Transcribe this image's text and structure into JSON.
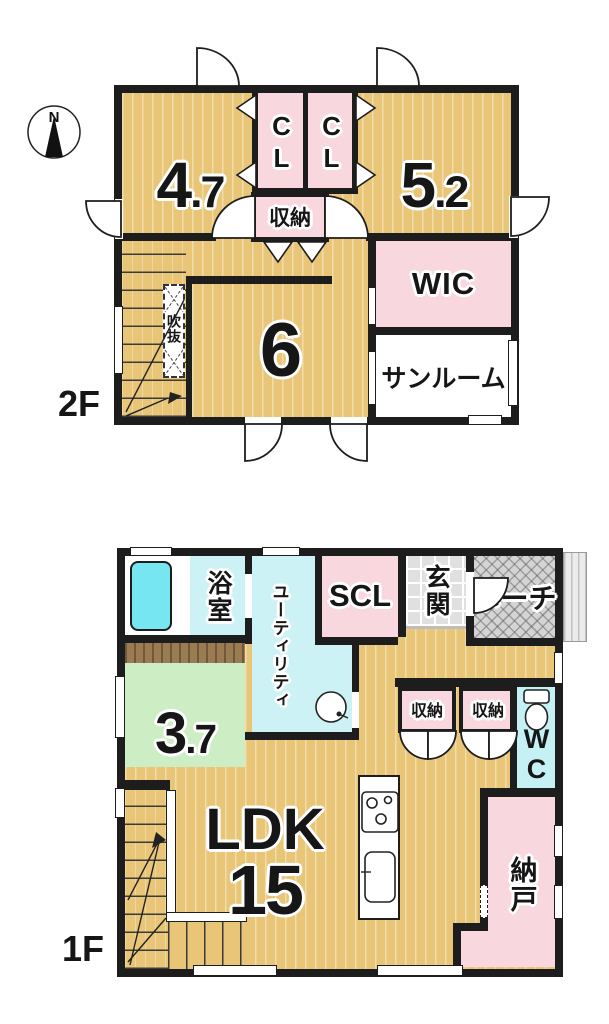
{
  "compass": {
    "label": "N"
  },
  "colors": {
    "wall": "#1d1d1d",
    "floor_yellow": "#e9c677",
    "pink": "#f8d7de",
    "cyan": "#cdf2f6",
    "tub_cyan": "#76e6f0",
    "wc_cyan": "#c5f0f4",
    "green": "#cdeec4",
    "brown": "#9b7b52",
    "tile_gray": "#e0e0e0",
    "porch_gray": "#d4d4d4",
    "paper": "#ffffff"
  },
  "floor2": {
    "label": "2F",
    "rooms": {
      "bedroom_left": "4.7",
      "closet_left": "CL",
      "closet_right": "CL",
      "storage": "収納",
      "bedroom_right": "5.2",
      "wic": "WIC",
      "sunroom": "サンルーム",
      "void": "吹抜",
      "bedroom_center": "6"
    }
  },
  "floor1": {
    "label": "1F",
    "rooms": {
      "bath": "浴室",
      "utility": "ユーティリティ",
      "scl": "SCL",
      "entrance": "玄関",
      "porch": "ポーチ",
      "tatami": "3.7",
      "storage_left": "収納",
      "storage_right": "収納",
      "wc": "WC",
      "ldk": "LDK",
      "ldk_size": "15",
      "storeroom": "納戸"
    }
  }
}
